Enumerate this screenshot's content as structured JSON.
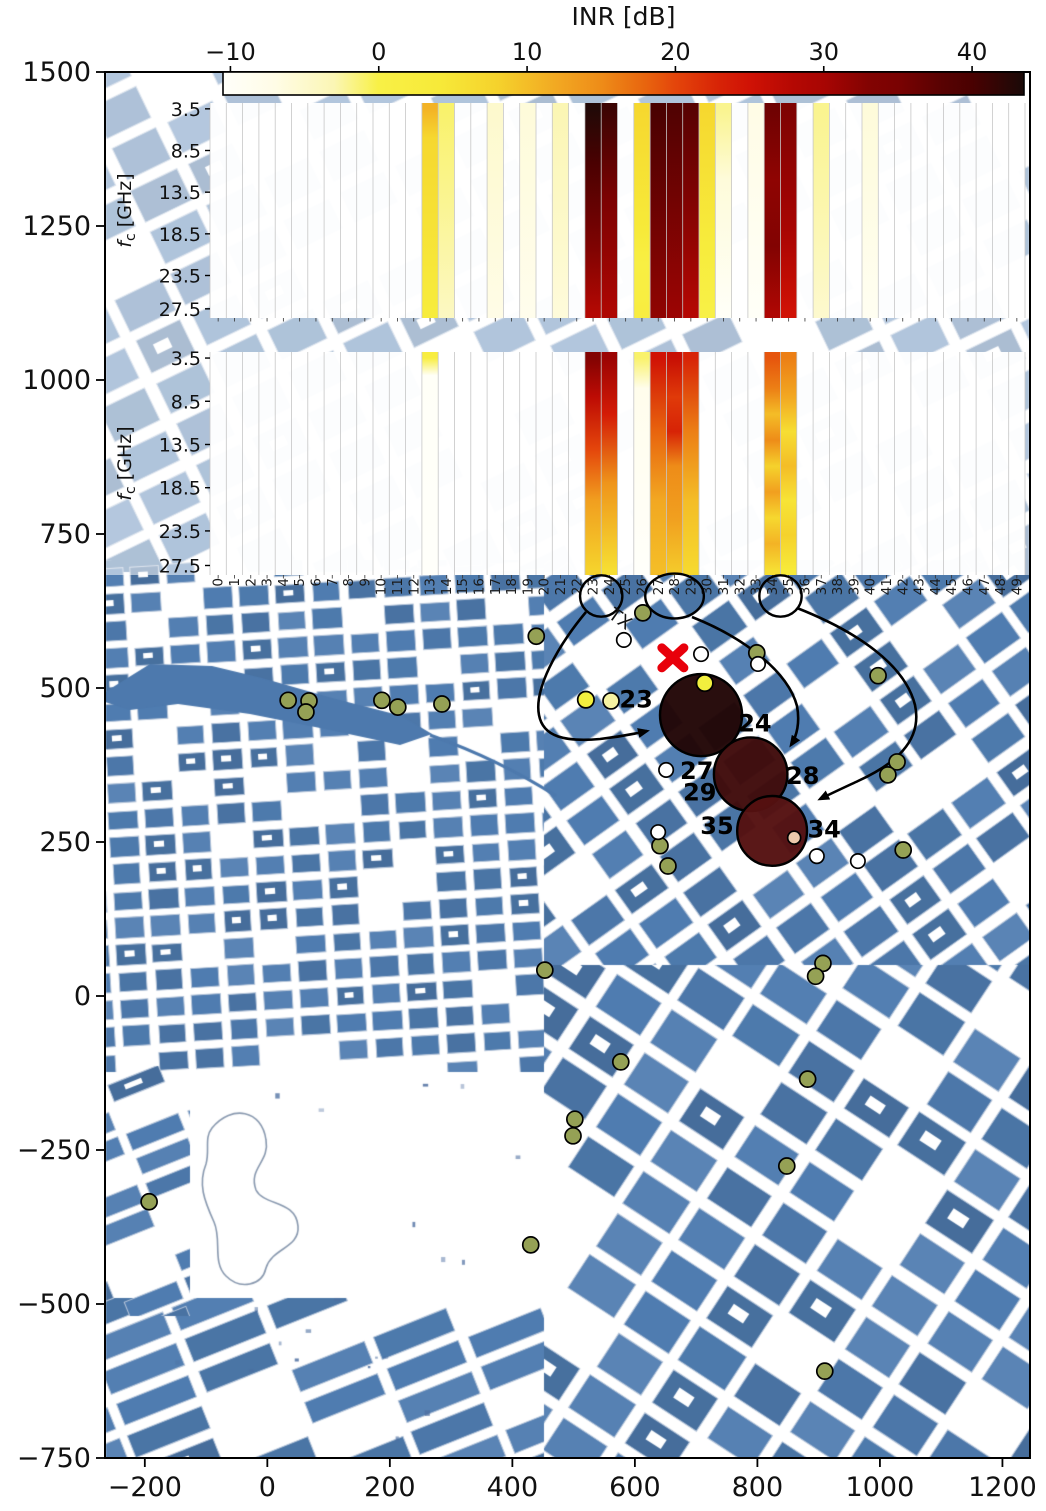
{
  "chart_data": {
    "type": "heatmap",
    "title": "INR [dB]",
    "colorbar": {
      "title": "INR [dB]",
      "tick_labels": [
        "−10",
        "0",
        "10",
        "20",
        "30",
        "40"
      ],
      "tick_values": [
        -10,
        0,
        10,
        20,
        30,
        40
      ],
      "vmin": -10.5,
      "vmax": 43.5,
      "colormap": "hot_r",
      "stops": [
        {
          "v": -10.5,
          "c": "#fffffa"
        },
        {
          "v": -7,
          "c": "#fffce6"
        },
        {
          "v": -3,
          "c": "#fbf6b4"
        },
        {
          "v": 0,
          "c": "#f8f046"
        },
        {
          "v": 4,
          "c": "#f7ea39"
        },
        {
          "v": 8,
          "c": "#f5d22c"
        },
        {
          "v": 12,
          "c": "#f2a822"
        },
        {
          "v": 15,
          "c": "#ee8c18"
        },
        {
          "v": 18,
          "c": "#e8640e"
        },
        {
          "v": 20,
          "c": "#e4450b"
        },
        {
          "v": 23,
          "c": "#d72306"
        },
        {
          "v": 25,
          "c": "#d01205"
        },
        {
          "v": 28,
          "c": "#b40803"
        },
        {
          "v": 30,
          "c": "#a80503"
        },
        {
          "v": 33,
          "c": "#820302"
        },
        {
          "v": 35,
          "c": "#7a0202"
        },
        {
          "v": 38,
          "c": "#580202"
        },
        {
          "v": 40,
          "c": "#4a0101"
        },
        {
          "v": 43.5,
          "c": "#1a0a08"
        }
      ]
    },
    "main_axes": {
      "x_tick_labels": [
        "−200",
        "0",
        "200",
        "400",
        "600",
        "800",
        "1000",
        "1200"
      ],
      "x_tick_values": [
        -200,
        0,
        200,
        400,
        600,
        800,
        1000,
        1200
      ],
      "y_tick_labels": [
        "1500",
        "1250",
        "1000",
        "750",
        "500",
        "250",
        "0",
        "−250",
        "−500",
        "−750"
      ],
      "y_tick_values": [
        1500,
        1250,
        1000,
        750,
        500,
        250,
        0,
        -250,
        -500,
        -750
      ],
      "x_range": [
        -265,
        1245
      ],
      "y_range": [
        -750,
        1500
      ],
      "grid": false
    },
    "panels": [
      {
        "name": "spectrogram-rx-top",
        "ylabel": {
          "f": "f",
          "sub": "c",
          "rest": " [GHz]"
        },
        "ytick_labels": [
          "3.5",
          "8.5",
          "13.5",
          "18.5",
          "23.5",
          "27.5"
        ],
        "ytick_values": [
          3.5,
          8.5,
          13.5,
          18.5,
          23.5,
          27.5
        ],
        "f_range": [
          2.8,
          28.6
        ],
        "n_channels": 50,
        "columns": [
          {
            "ch": 13,
            "profile": [
              [
                3.5,
                11
              ],
              [
                7,
                7
              ],
              [
                28,
                3
              ]
            ]
          },
          {
            "ch": 14,
            "profile": [
              [
                3.5,
                -1
              ],
              [
                28,
                -4
              ]
            ]
          },
          {
            "ch": 17,
            "profile": [
              [
                3.5,
                -5
              ],
              [
                28,
                -7
              ]
            ]
          },
          {
            "ch": 19,
            "profile": [
              [
                3.5,
                -6
              ],
              [
                28,
                -8
              ]
            ]
          },
          {
            "ch": 21,
            "profile": [
              [
                3.5,
                -3
              ],
              [
                28,
                -6
              ]
            ]
          },
          {
            "ch": 23,
            "profile": [
              [
                3.5,
                43
              ],
              [
                10,
                40
              ],
              [
                20,
                34
              ],
              [
                28,
                28
              ]
            ]
          },
          {
            "ch": 24,
            "profile": [
              [
                3.5,
                41
              ],
              [
                14,
                35
              ],
              [
                28,
                29
              ]
            ]
          },
          {
            "ch": 26,
            "profile": [
              [
                3.5,
                7
              ],
              [
                18,
                4
              ],
              [
                22,
                1
              ],
              [
                28,
                2
              ]
            ]
          },
          {
            "ch": 27,
            "profile": [
              [
                3.5,
                40
              ],
              [
                28,
                32
              ]
            ]
          },
          {
            "ch": 28,
            "profile": [
              [
                3.5,
                39
              ],
              [
                28,
                31
              ]
            ]
          },
          {
            "ch": 29,
            "profile": [
              [
                3.5,
                38
              ],
              [
                15,
                33
              ],
              [
                28,
                28
              ]
            ]
          },
          {
            "ch": 30,
            "profile": [
              [
                3.5,
                7
              ],
              [
                20,
                3
              ],
              [
                28,
                0
              ]
            ]
          },
          {
            "ch": 31,
            "profile": [
              [
                3.5,
                -2
              ],
              [
                12,
                -6
              ],
              [
                28,
                -10
              ]
            ]
          },
          {
            "ch": 33,
            "profile": [
              [
                3.5,
                -7
              ],
              [
                28,
                -10
              ]
            ]
          },
          {
            "ch": 34,
            "profile": [
              [
                3.5,
                36
              ],
              [
                12,
                32
              ],
              [
                20,
                33
              ],
              [
                28,
                29
              ]
            ]
          },
          {
            "ch": 35,
            "profile": [
              [
                3.5,
                34
              ],
              [
                18,
                30
              ],
              [
                28,
                25
              ]
            ]
          },
          {
            "ch": 37,
            "profile": [
              [
                3.5,
                -2
              ],
              [
                28,
                -5
              ]
            ]
          },
          {
            "ch": 40,
            "profile": [
              [
                3.5,
                -6
              ],
              [
                28,
                -9
              ]
            ]
          }
        ]
      },
      {
        "name": "spectrogram-rx-bottom",
        "ylabel": {
          "f": "f",
          "sub": "c",
          "rest": " [GHz]"
        },
        "ytick_labels": [
          "3.5",
          "8.5",
          "13.5",
          "18.5",
          "23.5",
          "27.5"
        ],
        "ytick_values": [
          3.5,
          8.5,
          13.5,
          18.5,
          23.5,
          27.5
        ],
        "f_range": [
          2.8,
          28.6
        ],
        "n_channels": 50,
        "columns": [
          {
            "ch": 13,
            "profile": [
              [
                3.5,
                2
              ],
              [
                5.5,
                -10
              ],
              [
                28,
                -11
              ]
            ]
          },
          {
            "ch": 23,
            "profile": [
              [
                3.5,
                33
              ],
              [
                8,
                27
              ],
              [
                14,
                20
              ],
              [
                20,
                13
              ],
              [
                28,
                8
              ]
            ]
          },
          {
            "ch": 24,
            "profile": [
              [
                3.5,
                31
              ],
              [
                10,
                24
              ],
              [
                18,
                14
              ],
              [
                28,
                6
              ]
            ]
          },
          {
            "ch": 26,
            "profile": [
              [
                3.5,
                -1
              ],
              [
                7,
                -8
              ],
              [
                28,
                -11
              ]
            ]
          },
          {
            "ch": 27,
            "profile": [
              [
                3.5,
                25
              ],
              [
                12,
                18
              ],
              [
                20,
                12
              ],
              [
                28,
                10
              ]
            ]
          },
          {
            "ch": 28,
            "profile": [
              [
                3.5,
                26
              ],
              [
                8,
                21
              ],
              [
                12,
                23
              ],
              [
                16,
                15
              ],
              [
                22,
                13
              ],
              [
                28,
                9
              ]
            ]
          },
          {
            "ch": 29,
            "profile": [
              [
                3.5,
                23
              ],
              [
                12,
                16
              ],
              [
                20,
                10
              ],
              [
                28,
                7
              ]
            ]
          },
          {
            "ch": 34,
            "profile": [
              [
                3.5,
                19
              ],
              [
                7,
                16
              ],
              [
                10,
                10
              ],
              [
                13,
                15
              ],
              [
                16,
                8
              ],
              [
                19,
                13
              ],
              [
                22,
                7
              ],
              [
                25,
                11
              ],
              [
                28,
                6
              ]
            ]
          },
          {
            "ch": 35,
            "profile": [
              [
                3.5,
                16
              ],
              [
                8,
                12
              ],
              [
                12,
                6
              ],
              [
                16,
                10
              ],
              [
                20,
                5
              ],
              [
                24,
                8
              ],
              [
                28,
                4
              ]
            ]
          }
        ]
      }
    ],
    "channel_axis": {
      "labels": [
        "0",
        "1",
        "2",
        "3",
        "4",
        "5",
        "6",
        "7",
        "8",
        "9",
        "10",
        "11",
        "12",
        "13",
        "14",
        "15",
        "16",
        "17",
        "18",
        "19",
        "20",
        "21",
        "22",
        "23",
        "24",
        "25",
        "26",
        "27",
        "28",
        "29",
        "30",
        "31",
        "32",
        "33",
        "34",
        "35",
        "36",
        "37",
        "38",
        "39",
        "40",
        "41",
        "42",
        "43",
        "44",
        "45",
        "46",
        "47",
        "48",
        "49"
      ],
      "circled_groups": [
        [
          23,
          24
        ],
        [
          27,
          28,
          29
        ],
        [
          34,
          35
        ]
      ]
    },
    "map": {
      "tx": {
        "x": 662,
        "y": 549,
        "label": "TX"
      },
      "interferers": [
        {
          "ids": "23,24",
          "x": 708,
          "y": 456,
          "r": 67,
          "fill": "#220606",
          "labels": [
            {
              "t": "23",
              "x": 602,
              "y": 481
            },
            {
              "t": "24",
              "x": 796,
              "y": 442
            }
          ]
        },
        {
          "ids": "27,28,29",
          "x": 789,
          "y": 360,
          "r": 60,
          "fill": "#400b0b",
          "labels": [
            {
              "t": "27",
              "x": 701,
              "y": 365
            },
            {
              "t": "29",
              "x": 706,
              "y": 330
            },
            {
              "t": "28",
              "x": 874,
              "y": 357
            }
          ]
        },
        {
          "ids": "34,35",
          "x": 824,
          "y": 268,
          "r": 57,
          "fill": "#551111",
          "labels": [
            {
              "t": "35",
              "x": 734,
              "y": 276
            },
            {
              "t": "34",
              "x": 909,
              "y": 270
            }
          ]
        }
      ],
      "dots": {
        "olive": [
          [
            439,
            584
          ],
          [
            613,
            622
          ],
          [
            799,
            557
          ],
          [
            997,
            520
          ],
          [
            1028,
            380
          ],
          [
            1013,
            359
          ],
          [
            34,
            480
          ],
          [
            68,
            479
          ],
          [
            63,
            461
          ],
          [
            187,
            480
          ],
          [
            213,
            469
          ],
          [
            285,
            474
          ],
          [
            641,
            244
          ],
          [
            654,
            211
          ],
          [
            1038,
            237
          ],
          [
            453,
            42
          ],
          [
            907,
            53
          ],
          [
            895,
            32
          ],
          [
            577,
            -107
          ],
          [
            882,
            -135
          ],
          [
            502,
            -200
          ],
          [
            499,
            -227
          ],
          [
            848,
            -276
          ],
          [
            430,
            -404
          ],
          [
            -193,
            -334
          ],
          [
            910,
            -609
          ]
        ],
        "yellow": [
          [
            714,
            508
          ],
          [
            520,
            481
          ]
        ],
        "pale_yellow": [
          [
            561,
            479
          ]
        ],
        "white": [
          [
            582,
            578
          ],
          [
            708,
            555
          ],
          [
            801,
            539
          ],
          [
            651,
            367
          ],
          [
            638,
            266
          ],
          [
            897,
            227
          ],
          [
            964,
            219
          ]
        ],
        "pink": [
          [
            860,
            257
          ]
        ]
      },
      "colors": {
        "building": "#4d79ad",
        "building_edge": "#b7c6da",
        "olive_dot": "#95a155",
        "yellow_dot": "#f2ef3e",
        "pale_yellow_dot": "#f6f3a2",
        "pink_dot": "#ecc9ac",
        "tx_red": "#e8000b"
      }
    }
  }
}
